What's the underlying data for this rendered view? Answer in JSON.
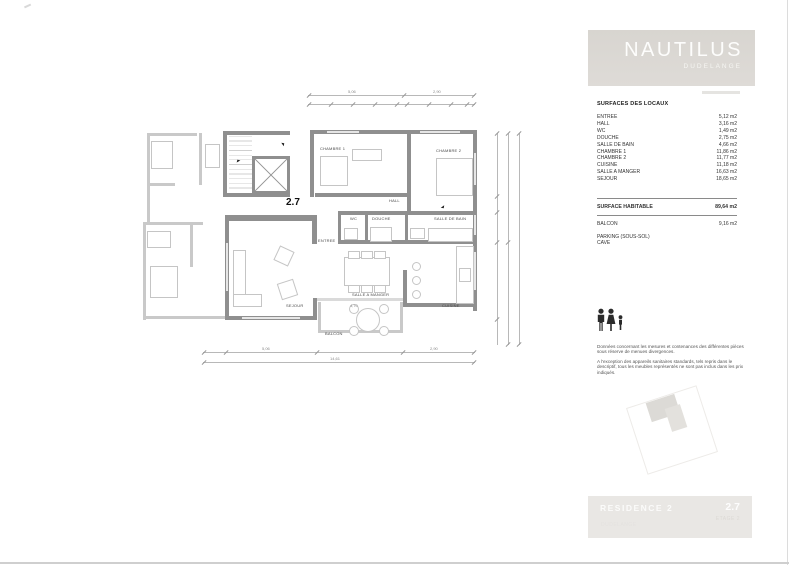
{
  "logo": {
    "name": "NAUTILUS",
    "city": "DUDELANGE"
  },
  "surfaces": {
    "title": "SURFACES DES LOCAUX",
    "rows": [
      {
        "label": "ENTREE",
        "value": "5,12 m2"
      },
      {
        "label": "HALL",
        "value": "3,16 m2"
      },
      {
        "label": "WC",
        "value": "1,49 m2"
      },
      {
        "label": "DOUCHE",
        "value": "2,75 m2"
      },
      {
        "label": "SALLE DE BAIN",
        "value": "4,66 m2"
      },
      {
        "label": "CHAMBRE 1",
        "value": "11,86 m2"
      },
      {
        "label": "CHAMBRE 2",
        "value": "11,77 m2"
      },
      {
        "label": "CUISINE",
        "value": "11,18 m2"
      },
      {
        "label": "SALLE A MANGER",
        "value": "16,63 m2"
      },
      {
        "label": "SEJOUR",
        "value": "18,65 m2"
      }
    ],
    "habitable": {
      "label": "SURFACE HABITABLE",
      "value": "89,64 m2"
    },
    "balcon": {
      "label": "BALCON",
      "value": "9,16 m2"
    },
    "parking": "PARKING (SOUS-SOL)",
    "cave": "CAVE"
  },
  "notes": {
    "para1": "Données concernant les mesures et contenances des différentes pièces sous réserve de menues divergences.",
    "para2": "A l'exception des appareils sanitaires standards, tels repris dans le descriptif, tous les meubles représentés ne sont pas inclus dans les prix indiqués."
  },
  "plan": {
    "unit": "2.7",
    "rooms": [
      "CHAMBRE 1",
      "CHAMBRE 2",
      "HALL",
      "WC",
      "DOUCHE",
      "SALLE DE BAIN",
      "ENTREE",
      "SALLE A MANGER",
      "SEJOUR",
      "CUISINE",
      "BALCON"
    ],
    "dims": {
      "top": [
        "5,06",
        "2,90"
      ],
      "bottom": [
        "5,06",
        "2,90"
      ],
      "total": "14,61",
      "balcony": "4,70"
    }
  },
  "footer": {
    "residence": "RESIDENCE 2",
    "unit": "2.7",
    "faint_right": "ETAGE 2",
    "faint_left": "DUDELANGE"
  },
  "colors": {
    "logo_bg": "#d9d6d1",
    "footer_bg": "#e9e7e4",
    "wall": "#8f8f8f",
    "wall_light": "#c9c9c9"
  }
}
